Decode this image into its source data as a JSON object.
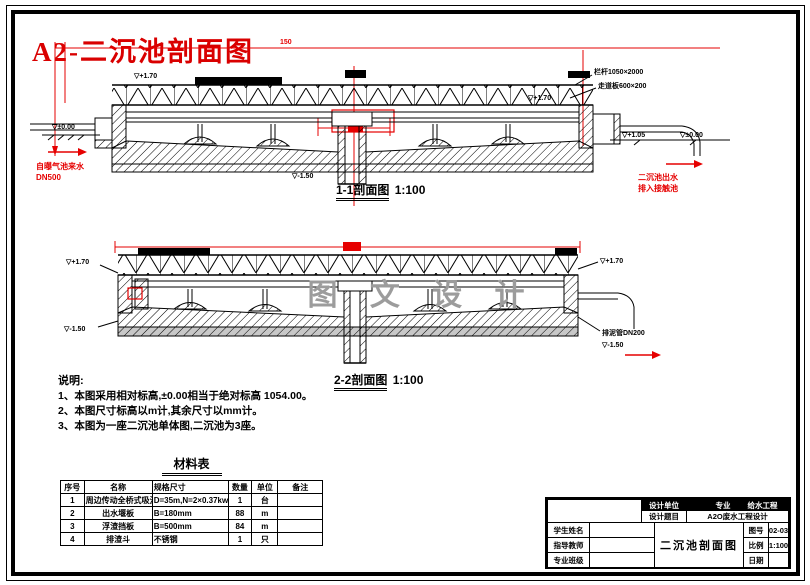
{
  "header": {
    "title": "A2-二沉池剖面图"
  },
  "sections": {
    "s1": {
      "name": "1-1剖面图",
      "scale": "1:100",
      "dim_top": "150",
      "elev_walkway": "▽+1.70",
      "rail_label": "栏杆1050×2000",
      "walkway_label": "走道板600×200",
      "elev_water_right": "▽+1.70",
      "elev_ground_left": "▽±0.00",
      "elev_ground_right1": "▽+1.05",
      "elev_ground_right2": "▽±0.00",
      "elev_center": "▽-1.50",
      "inlet_text1": "自曝气池来水",
      "inlet_text2": "DN500",
      "outlet_text1": "二沉池出水",
      "outlet_text2": "排入接触池"
    },
    "s2": {
      "name": "2-2剖面图",
      "scale": "1:100",
      "watermark": "图 文 设 计",
      "elev_left_top": "▽+1.70",
      "elev_left_bottom": "▽-1.50",
      "mud_pipe_label": "排泥管DN200",
      "elev_right_bottom": "▽-1.50",
      "elev_right_top": "▽+1.70"
    }
  },
  "notes": {
    "title": "说明:",
    "items": [
      "1、本图采用相对标高,±0.00相当于绝对标高 1054.00。",
      "2、本图尺寸标高以m计,其余尺寸以mm计。",
      "3、本图为一座二沉池单体图,二沉池为3座。"
    ]
  },
  "materials": {
    "title": "材料表",
    "headers": [
      "序号",
      "名称",
      "规格尺寸",
      "数量",
      "单位",
      "备注"
    ],
    "rows": [
      [
        "1",
        "周边传动全桥式吸泥机",
        "D=35m,N=2×0.37kw",
        "1",
        "台",
        ""
      ],
      [
        "2",
        "出水堰板",
        "B=180mm",
        "88",
        "m",
        ""
      ],
      [
        "3",
        "浮渣挡板",
        "B=500mm",
        "84",
        "m",
        ""
      ],
      [
        "4",
        "排渣斗",
        "不锈钢",
        "1",
        "只",
        ""
      ]
    ]
  },
  "titleblock": {
    "unit_label": "设计单位",
    "major_label": "专业",
    "major_value": "给水工程",
    "project_label": "设计题目",
    "project_value": "A2O废水工程设计",
    "left_rows": [
      "学生姓名",
      "指导教师",
      "专业班级"
    ],
    "drawing_title": "二沉池剖面图",
    "right_rows": [
      [
        "图号",
        "02-03"
      ],
      [
        "比例",
        "1:100"
      ],
      [
        "日期",
        ""
      ]
    ]
  },
  "colors": {
    "accent_red": "#e60000",
    "watermark_gray": "#9c9c9c"
  }
}
